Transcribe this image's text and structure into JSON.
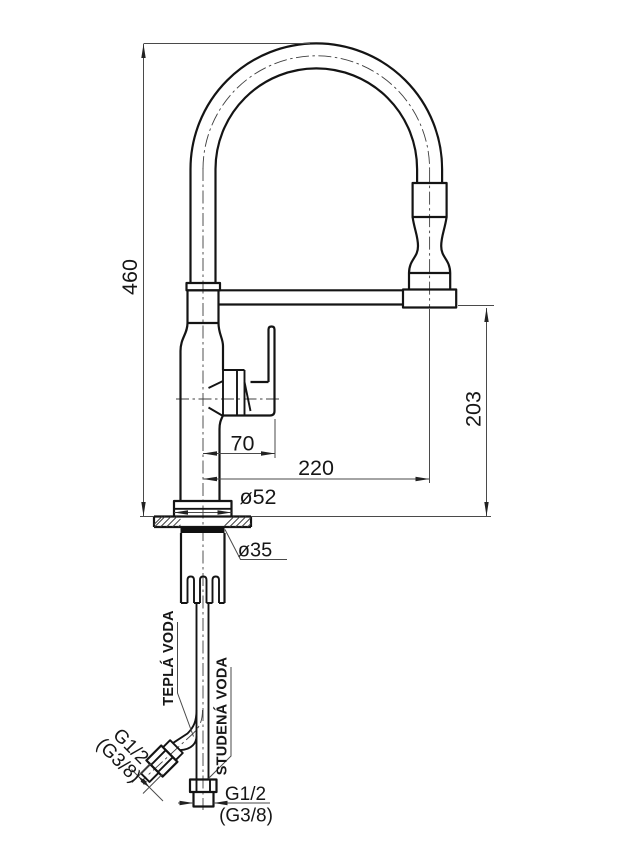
{
  "drawing": {
    "background": "#ffffff",
    "line_color": "#141414",
    "dimensions": {
      "total_height": "460",
      "outlet_height": "203",
      "handle_reach": "70",
      "spout_reach": "220",
      "base_diameter": "ø52",
      "shank_diameter": "ø35"
    },
    "connections": {
      "hot_label": "TEPLÁ VODA",
      "cold_label": "STUDENÁ VODA",
      "hot_thread": "G1/2",
      "hot_thread_alt": "(G3/8)",
      "cold_thread": "G1/2",
      "cold_thread_alt": "(G3/8)"
    }
  }
}
